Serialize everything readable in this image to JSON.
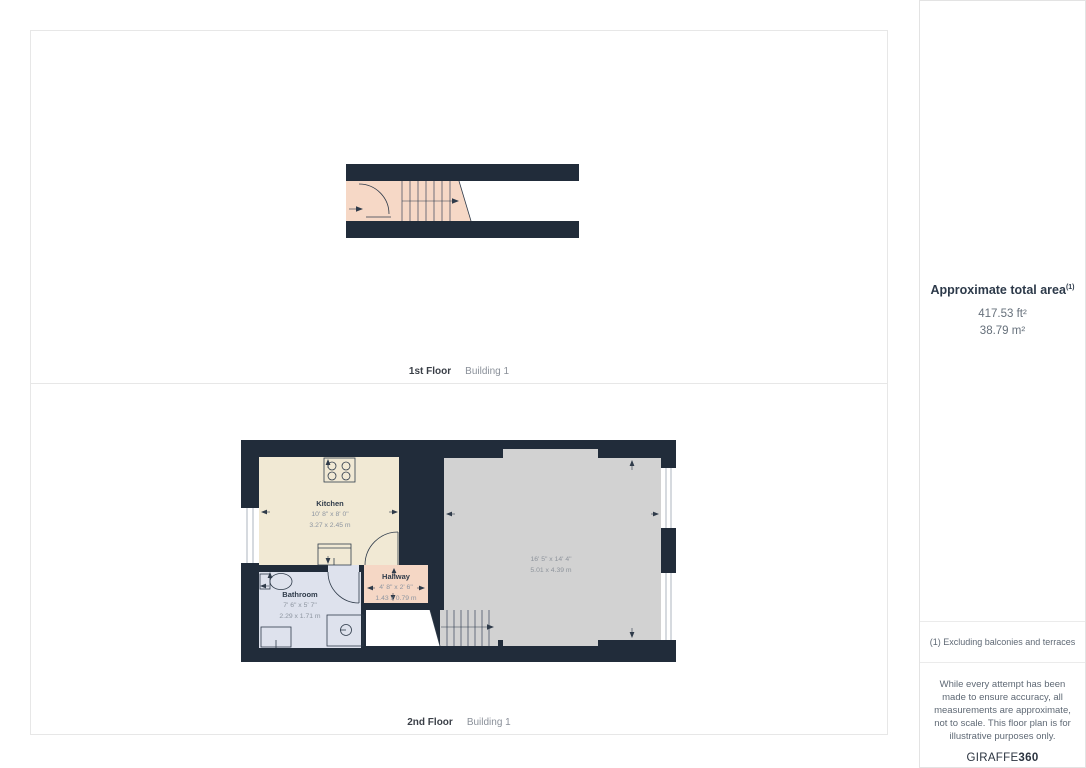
{
  "panels": {
    "floor1": {
      "floor_label": "1st Floor",
      "building_label": "Building 1"
    },
    "floor2": {
      "floor_label": "2nd Floor",
      "building_label": "Building 1",
      "rooms": {
        "kitchen": {
          "name": "Kitchen",
          "dims_ft": "10' 8\" x 8' 0\"",
          "dims_m": "3.27 x 2.45 m"
        },
        "bathroom": {
          "name": "Bathroom",
          "dims_ft": "7' 6\" x 5' 7\"",
          "dims_m": "2.29 x 1.71 m"
        },
        "hallway": {
          "name": "Hallway",
          "dims_ft": "4' 8\" x 2' 6\"",
          "dims_m": "1.43 x 0.79 m"
        },
        "living": {
          "dims_ft": "16' 5\" x 14' 4\"",
          "dims_m": "5.01 x 4.39 m"
        }
      }
    }
  },
  "sidebar": {
    "area_title": "Approximate total area",
    "area_superscript": "(1)",
    "area_ft": "417.53 ft²",
    "area_m": "38.79 m²",
    "footnote": "(1) Excluding balconies and terraces",
    "disclaimer": "While every attempt has been made to ensure accuracy, all measurements are approximate, not to scale. This floor plan is for illustrative purposes only.",
    "logo_text": "GIRAFFE",
    "logo_suffix": "360"
  },
  "colors": {
    "wall": "#212c3a",
    "kitchen_floor": "#f1e9d4",
    "bathroom_floor": "#dee2ed",
    "hallway_floor": "#f5d7c5",
    "living_floor": "#d2d2d2",
    "stairs_floor": "#f6d8c6"
  }
}
